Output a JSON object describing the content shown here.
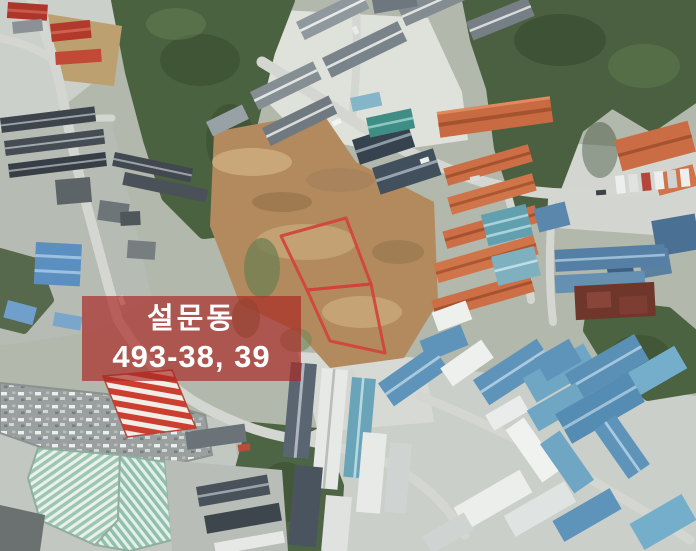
{
  "map": {
    "kind": "satellite-aerial-annotated",
    "annotation_label": {
      "line1": "설문동",
      "line2": "493-38, 39",
      "text_color": "#ffffff",
      "background_color": "rgba(170,40,36,0.68)"
    },
    "parcel_outline": {
      "color": "#d2423c",
      "stroke_width": 3,
      "upper_points": "346,218 281,236 307,290 371,284",
      "lower_points": "307,290 371,284 385,353 330,341"
    }
  }
}
